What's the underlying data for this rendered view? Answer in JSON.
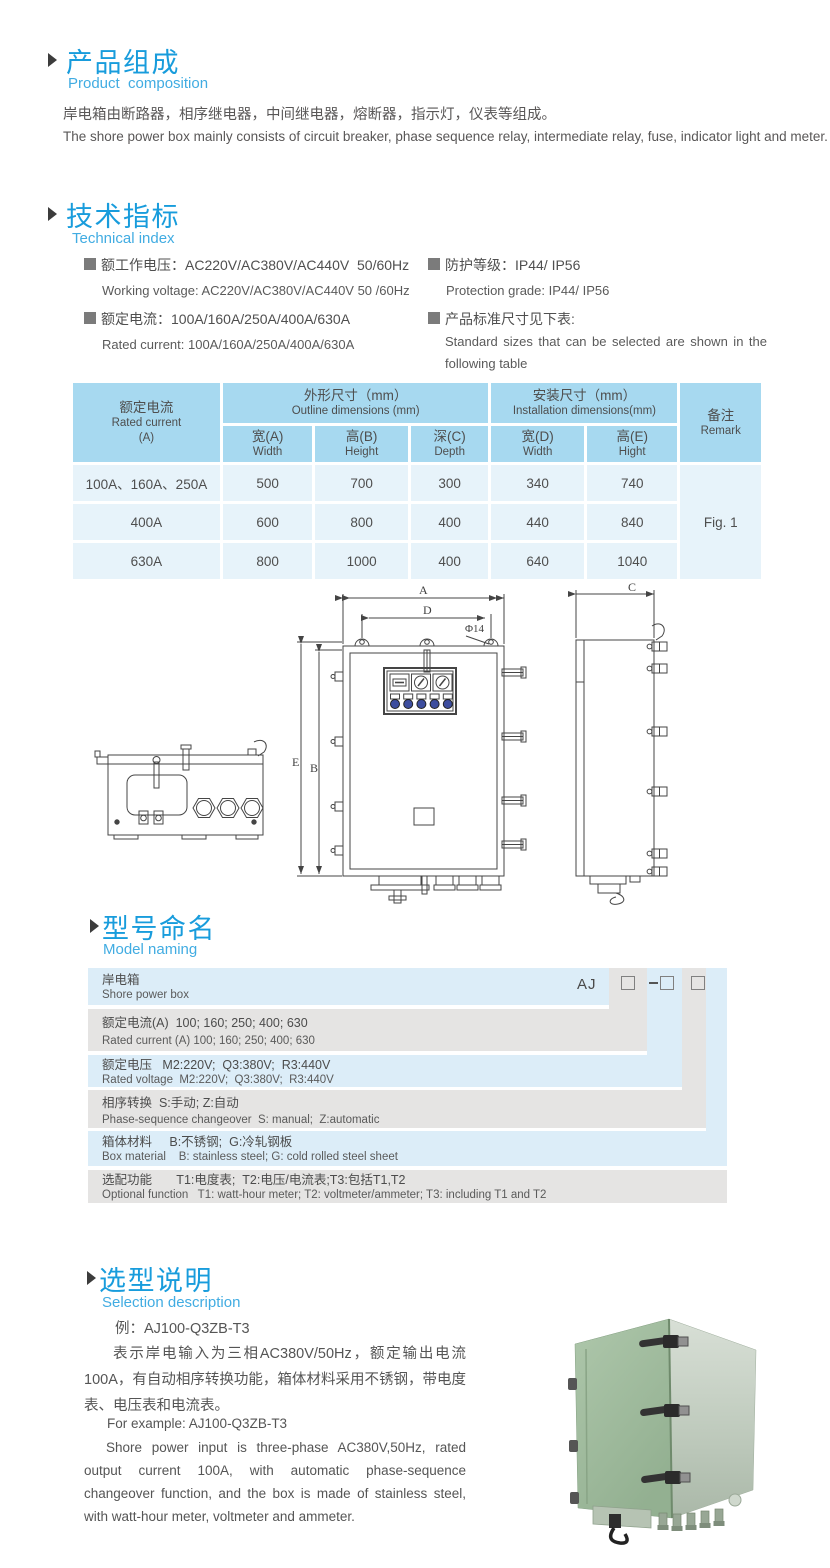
{
  "accent_color": "#189cdc",
  "subtitle_color": "#41ace2",
  "table_header_color": "#a7d9f0",
  "table_row_color": "#e7f3fa",
  "s1": {
    "title_zh": "产品组成",
    "title_en": "Product  composition",
    "body_zh": "岸电箱由断路器，相序继电器，中间继电器，熔断器，指示灯，仪表等组成。",
    "body_en": "The shore power box mainly consists of circuit breaker, phase sequence relay, intermediate relay, fuse, indicator light and meter."
  },
  "s2": {
    "title_zh": "技术指标",
    "title_en": "Technical index",
    "specs": [
      {
        "zh": "额工作电压：AC220V/AC380V/AC440V  50/60Hz",
        "en": "Working voltage: AC220V/AC380V/AC440V 50 /60Hz"
      },
      {
        "zh": "额定电流：100A/160A/250A/400A/630A",
        "en": "Rated current: 100A/160A/250A/400A/630A"
      },
      {
        "zh": "防护等级：IP44/ IP56",
        "en": "Protection grade: IP44/ IP56"
      },
      {
        "zh": "产品标准尺寸见下表:",
        "en": "Standard sizes that can be selected are shown in the following table"
      }
    ]
  },
  "table": {
    "header": {
      "current_zh": "额定电流",
      "current_en": "Rated current",
      "current_unit": "(A)",
      "outline_zh": "外形尺寸（mm）",
      "outline_en": "Outline dimensions (mm)",
      "install_zh": "安装尺寸（mm）",
      "install_en": "Installation dimensions(mm)",
      "remark_zh": "备注",
      "remark_en": "Remark",
      "cols": [
        {
          "zh": "宽(A)",
          "en": "Width"
        },
        {
          "zh": "高(B)",
          "en": "Height"
        },
        {
          "zh": "深(C)",
          "en": "Depth"
        },
        {
          "zh": "宽(D)",
          "en": "Width"
        },
        {
          "zh": "高(E)",
          "en": "Hight"
        }
      ]
    },
    "rows": [
      {
        "current": "100A、160A、250A",
        "w": "500",
        "h": "700",
        "d": "300",
        "iw": "340",
        "ih": "740"
      },
      {
        "current": "400A",
        "w": "600",
        "h": "800",
        "d": "400",
        "iw": "440",
        "ih": "840"
      },
      {
        "current": "630A",
        "w": "800",
        "h": "1000",
        "d": "400",
        "iw": "640",
        "ih": "1040"
      }
    ],
    "remark": "Fig. 1"
  },
  "drawing": {
    "labels": {
      "a": "A",
      "d": "D",
      "dia": "Φ14",
      "e": "E",
      "b": "B",
      "c": "C"
    }
  },
  "model": {
    "title_zh": "型号命名",
    "title_en": "Model naming",
    "prefix": "AJ",
    "rows": [
      {
        "zh": "岸电箱",
        "en": "Shore power box"
      },
      {
        "zh": "额定电流(A)  100; 160; 250; 400; 630",
        "en": "Rated current (A) 100; 160; 250; 400; 630"
      },
      {
        "zh": "额定电压   M2:220V;  Q3:380V;  R3:440V",
        "en": "Rated voltage  M2:220V;  Q3:380V;  R3:440V"
      },
      {
        "zh": "相序转换  S:手动; Z:自动",
        "en": "Phase-sequence changeover  S: manual;  Z:automatic"
      },
      {
        "zh": "箱体材料     B:不锈钢;  G:冷轧钢板",
        "en": "Box material    B: stainless steel; G: cold rolled steel sheet"
      },
      {
        "zh": "选配功能       T1:电度表;  T2:电压/电流表;T3:包括T1,T2",
        "en": "Optional function   T1: watt-hour meter; T2: voltmeter/ammeter; T3: including T1 and T2"
      }
    ]
  },
  "sel": {
    "title_zh": "选型说明",
    "title_en": "Selection description",
    "example_zh": "例：AJ100-Q3ZB-T3",
    "para_zh": "表示岸电输入为三相AC380V/50Hz，额定输出电流100A，有自动相序转换功能，箱体材料采用不锈钢，带电度表、电压表和电流表。",
    "example_en": "For example: AJ100-Q3ZB-T3",
    "para_en": "Shore power input is three-phase AC380V,50Hz, rated output current 100A, with automatic phase-sequence changeover function, and the box is made of stainless steel, with watt-hour meter, voltmeter and ammeter."
  }
}
